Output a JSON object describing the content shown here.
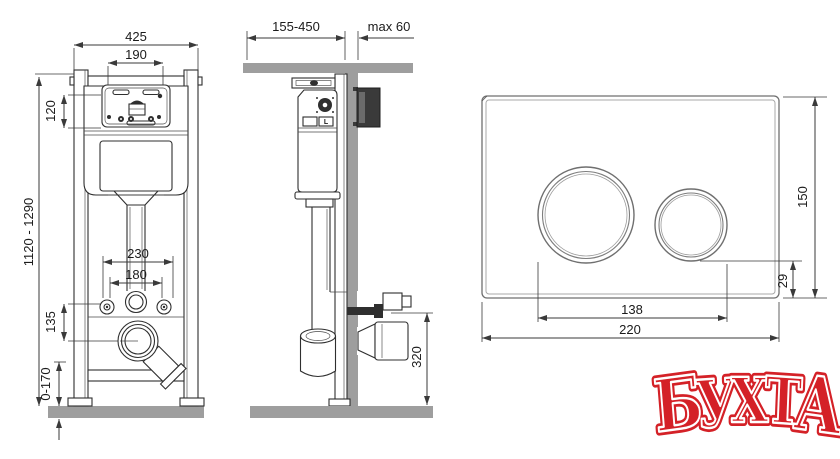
{
  "drawing": {
    "front_view": {
      "width_total": "425",
      "opening_width": "190",
      "panel_height": "120",
      "frame_height_range": "1120 - 1290",
      "fixing_span_outer": "230",
      "fixing_span_inner": "180",
      "drain_offset": "135",
      "foot_adjust_range": "0-170"
    },
    "side_view": {
      "depth_range": "155-450",
      "wall_thickness_max": "max 60",
      "outlet_height": "320",
      "valve_label": "L"
    },
    "flush_plate": {
      "plate_height": "150",
      "button_bottom_offset": "29",
      "button_span": "138",
      "plate_width": "220"
    }
  },
  "watermark": {
    "text": "БУХТА",
    "letters": [
      "Б",
      "У",
      "Х",
      "Т",
      "А"
    ],
    "color": "#d42127"
  },
  "colors": {
    "line": "#2f2f2f",
    "gray_fill": "#9e9e9e",
    "dark_block": "#3a3a3a",
    "plate_line": "#6f6f6f",
    "watermark_red": "#d42127"
  }
}
